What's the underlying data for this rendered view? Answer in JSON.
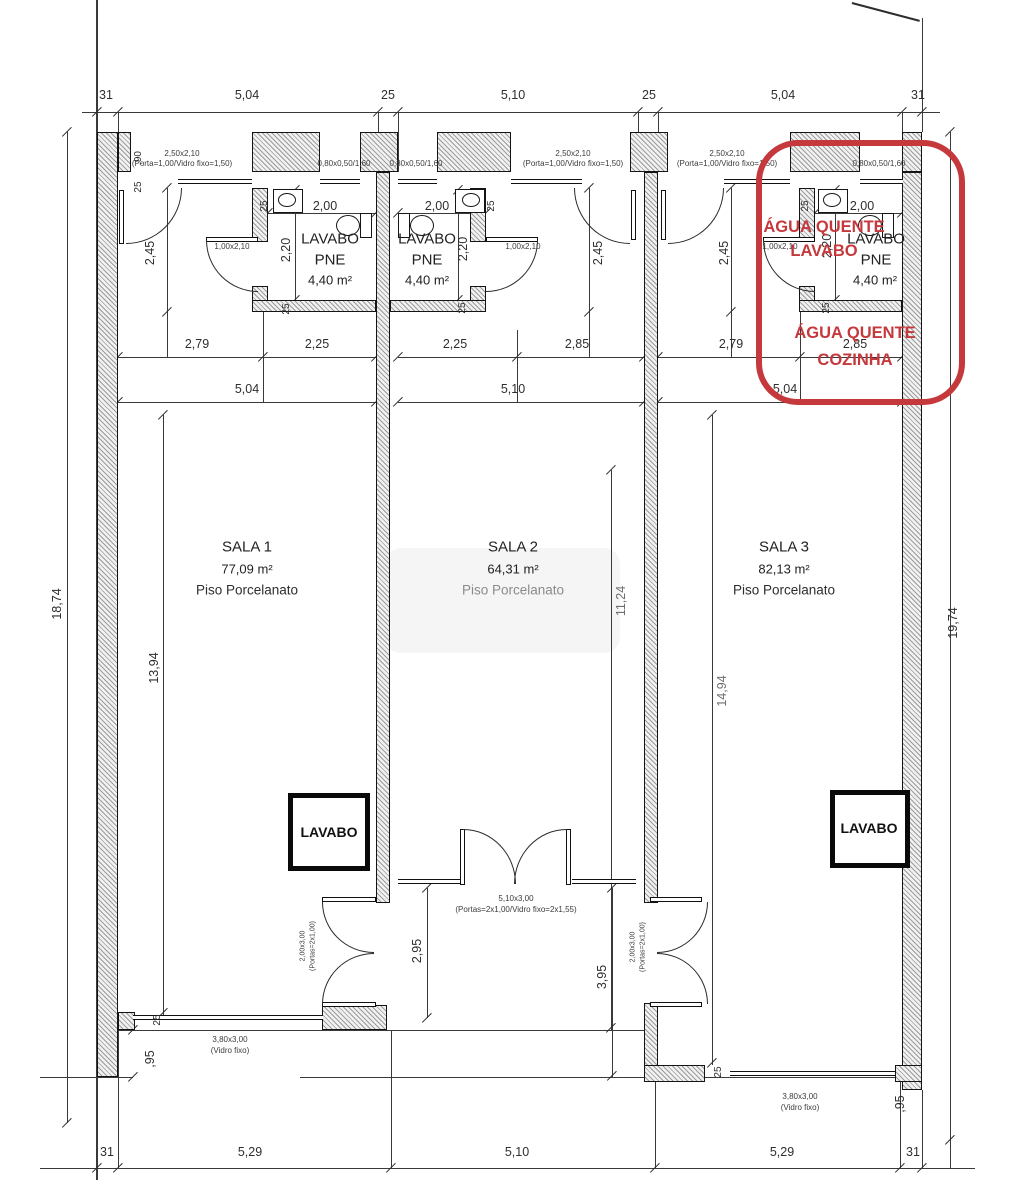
{
  "summary": {
    "type": "architectural floor plan - 3 commercial rooms",
    "highlight_color": "#c5393d",
    "units": [
      {
        "room": "SALA 1",
        "area": "77,09 m²",
        "floor": "Piso Porcelanato",
        "bath": "LAVABO PNE",
        "bath_area": "4,40 m²"
      },
      {
        "room": "SALA 2",
        "area": "64,31 m²",
        "floor": "Piso Porcelanato",
        "bath": "LAVABO PNE",
        "bath_area": "4,40 m²"
      },
      {
        "room": "SALA 3",
        "area": "82,13 m²",
        "floor": "Piso Porcelanato",
        "bath": "LAVABO PNE",
        "bath_area": "4,40 m²"
      }
    ],
    "red_notes": [
      "ÁGUA QUENTE LAVABO",
      "ÁGUA QUENTE COZINHA"
    ],
    "top_dimensions": [
      "31",
      "5,04",
      "25",
      "5,10",
      "25",
      "5,04",
      "31"
    ],
    "bottom_dimensions": [
      "31",
      "5,29",
      "5,10",
      "5,29",
      "31"
    ]
  },
  "labels": [
    {
      "name": "dim-top-31a",
      "text": "31",
      "x": 106,
      "y": 95
    },
    {
      "name": "dim-top-504a",
      "text": "5,04",
      "x": 247,
      "y": 95
    },
    {
      "name": "dim-top-25a",
      "text": "25",
      "x": 388,
      "y": 95
    },
    {
      "name": "dim-top-510",
      "text": "5,10",
      "x": 513,
      "y": 95
    },
    {
      "name": "dim-top-25b",
      "text": "25",
      "x": 649,
      "y": 95
    },
    {
      "name": "dim-top-504b",
      "text": "5,04",
      "x": 783,
      "y": 95
    },
    {
      "name": "dim-top-31b",
      "text": "31",
      "x": 918,
      "y": 95
    },
    {
      "name": "spec-door1-a",
      "text": "2,50x2,10",
      "x": 182,
      "y": 154,
      "size": 8,
      "color": "#3c3c3c"
    },
    {
      "name": "spec-door1-b",
      "text": "(Porta=1,00/Vidro fixo=1,50)",
      "x": 182,
      "y": 164,
      "size": 8,
      "color": "#3c3c3c"
    },
    {
      "name": "spec-win1",
      "text": "0,80x0,50/1,60",
      "x": 344,
      "y": 164,
      "size": 8,
      "color": "#3c3c3c"
    },
    {
      "name": "spec-win2",
      "text": "0,80x0,50/1,60",
      "x": 416,
      "y": 164,
      "size": 8,
      "color": "#3c3c3c"
    },
    {
      "name": "spec-door2-a",
      "text": "2,50x2,10",
      "x": 573,
      "y": 154,
      "size": 8,
      "color": "#3c3c3c"
    },
    {
      "name": "spec-door2-b",
      "text": "(Porta=1,00/Vidro fixo=1,50)",
      "x": 573,
      "y": 164,
      "size": 8,
      "color": "#3c3c3c"
    },
    {
      "name": "spec-door3-a",
      "text": "2,50x2,10",
      "x": 727,
      "y": 154,
      "size": 8,
      "color": "#3c3c3c"
    },
    {
      "name": "spec-door3-b",
      "text": "(Porta=1,00/Vidro fixo=1,50)",
      "x": 727,
      "y": 164,
      "size": 8,
      "color": "#3c3c3c"
    },
    {
      "name": "spec-win3",
      "text": "0,80x0,50/1,60",
      "x": 879,
      "y": 164,
      "size": 8,
      "color": "#3c3c3c"
    },
    {
      "name": "dim-90",
      "text": ",90",
      "x": 139,
      "y": 158,
      "rot": true,
      "size": 10
    },
    {
      "name": "dim-25-tl",
      "text": "25",
      "x": 139,
      "y": 187,
      "rot": true,
      "size": 10
    },
    {
      "name": "dim-200-u1",
      "text": "2,00",
      "x": 325,
      "y": 206
    },
    {
      "name": "dim-200-u2",
      "text": "2,00",
      "x": 437,
      "y": 206
    },
    {
      "name": "dim-200-u3",
      "text": "2,00",
      "x": 862,
      "y": 206
    },
    {
      "name": "dim-25-b1",
      "text": "25",
      "x": 265,
      "y": 206,
      "rot": true,
      "size": 10
    },
    {
      "name": "dim-25-b2",
      "text": "25",
      "x": 492,
      "y": 206,
      "rot": true,
      "size": 10
    },
    {
      "name": "dim-25-b3",
      "text": "25",
      "x": 806,
      "y": 206,
      "rot": true,
      "size": 10
    },
    {
      "name": "dim-220-u1",
      "text": "2,20",
      "x": 286,
      "y": 250,
      "rot": true
    },
    {
      "name": "dim-220-u2",
      "text": "2,20",
      "x": 463,
      "y": 249,
      "rot": true
    },
    {
      "name": "dim-220-u3",
      "text": "2,20",
      "x": 827,
      "y": 246,
      "rot": true
    },
    {
      "name": "dim-245-u1",
      "text": "2,45",
      "x": 150,
      "y": 253,
      "rot": true
    },
    {
      "name": "dim-245-u2",
      "text": "2,45",
      "x": 598,
      "y": 253,
      "rot": true
    },
    {
      "name": "dim-245-u3",
      "text": "2,45",
      "x": 724,
      "y": 253,
      "rot": true
    },
    {
      "name": "spec-bathdoor1",
      "text": "1,00x2,10",
      "x": 232,
      "y": 247,
      "size": 8,
      "color": "#3c3c3c"
    },
    {
      "name": "spec-bathdoor2",
      "text": "1,00x2,10",
      "x": 523,
      "y": 247,
      "size": 8,
      "color": "#3c3c3c"
    },
    {
      "name": "spec-bathdoor3",
      "text": "1,00x2,10",
      "x": 780,
      "y": 247,
      "size": 8,
      "color": "#3c3c3c"
    },
    {
      "name": "dim-25-c1",
      "text": "25",
      "x": 287,
      "y": 309,
      "rot": true,
      "size": 10
    },
    {
      "name": "dim-25-c2",
      "text": "25",
      "x": 463,
      "y": 308,
      "rot": true,
      "size": 10
    },
    {
      "name": "dim-25-c3",
      "text": "25",
      "x": 827,
      "y": 308,
      "rot": true,
      "size": 10
    },
    {
      "name": "room-bath1-name",
      "text": "LAVABO",
      "x": 330,
      "y": 239,
      "size": 15,
      "color": "#222222"
    },
    {
      "name": "room-bath1-pne",
      "text": "PNE",
      "x": 330,
      "y": 260,
      "size": 15,
      "color": "#222222"
    },
    {
      "name": "room-bath1-area",
      "text": "4,40 m²",
      "x": 330,
      "y": 280,
      "size": 13,
      "color": "#222222"
    },
    {
      "name": "room-bath2-name",
      "text": "LAVABO",
      "x": 427,
      "y": 239,
      "size": 15,
      "color": "#222222"
    },
    {
      "name": "room-bath2-pne",
      "text": "PNE",
      "x": 427,
      "y": 260,
      "size": 15,
      "color": "#222222"
    },
    {
      "name": "room-bath2-area",
      "text": "4,40 m²",
      "x": 427,
      "y": 280,
      "size": 13,
      "color": "#222222"
    },
    {
      "name": "room-bath3-name",
      "text": "LAVABO",
      "x": 876,
      "y": 239,
      "size": 15,
      "color": "#222222"
    },
    {
      "name": "room-bath3-pne",
      "text": "PNE",
      "x": 876,
      "y": 260,
      "size": 15,
      "color": "#222222"
    },
    {
      "name": "room-bath3-area",
      "text": "4,40 m²",
      "x": 875,
      "y": 280,
      "size": 13,
      "color": "#222222"
    },
    {
      "name": "dim-279-u1",
      "text": "2,79",
      "x": 197,
      "y": 344
    },
    {
      "name": "dim-225-u1",
      "text": "2,25",
      "x": 317,
      "y": 344
    },
    {
      "name": "dim-225-u2",
      "text": "2,25",
      "x": 455,
      "y": 344
    },
    {
      "name": "dim-285-u2",
      "text": "2,85",
      "x": 577,
      "y": 344
    },
    {
      "name": "dim-279-u3",
      "text": "2,79",
      "x": 731,
      "y": 344
    },
    {
      "name": "dim-285-u3",
      "text": "2,85",
      "x": 855,
      "y": 344
    },
    {
      "name": "dim-504-u1",
      "text": "5,04",
      "x": 247,
      "y": 389
    },
    {
      "name": "dim-510-u2",
      "text": "5,10",
      "x": 513,
      "y": 389
    },
    {
      "name": "dim-504-u3",
      "text": "5,04",
      "x": 785,
      "y": 389
    },
    {
      "name": "note-agua-quente-1",
      "text": "ÁGUA QUENTE",
      "x": 824,
      "y": 227,
      "size": 16.5,
      "bold": true,
      "color": "#c5393d"
    },
    {
      "name": "note-lavabo",
      "text": "LAVABO",
      "x": 824,
      "y": 251,
      "size": 16.5,
      "bold": true,
      "color": "#c5393d"
    },
    {
      "name": "note-agua-quente-2",
      "text": "ÁGUA QUENTE",
      "x": 855,
      "y": 333,
      "size": 16.5,
      "bold": true,
      "color": "#c5393d"
    },
    {
      "name": "note-cozinha",
      "text": "COZINHA",
      "x": 855,
      "y": 360,
      "size": 16.5,
      "bold": true,
      "color": "#c5393d"
    },
    {
      "name": "room-sala1-name",
      "text": "SALA 1",
      "x": 247,
      "y": 547,
      "size": 15,
      "color": "#222222"
    },
    {
      "name": "room-sala1-area",
      "text": "77,09 m²",
      "x": 247,
      "y": 569,
      "size": 13,
      "color": "#222222"
    },
    {
      "name": "room-sala1-floor",
      "text": "Piso Porcelanato",
      "x": 247,
      "y": 590,
      "size": 13.5,
      "color": "#2e2e2e"
    },
    {
      "name": "room-sala2-name",
      "text": "SALA 2",
      "x": 513,
      "y": 547,
      "size": 15,
      "color": "#222222"
    },
    {
      "name": "room-sala2-area",
      "text": "64,31 m²",
      "x": 513,
      "y": 569,
      "size": 13,
      "color": "#222222"
    },
    {
      "name": "room-sala2-floor",
      "text": "Piso Porcelanato",
      "x": 513,
      "y": 590,
      "size": 13.5,
      "color": "#8b8b8b"
    },
    {
      "name": "room-sala3-name",
      "text": "SALA 3",
      "x": 784,
      "y": 547,
      "size": 15,
      "color": "#222222"
    },
    {
      "name": "room-sala3-area",
      "text": "82,13 m²",
      "x": 784,
      "y": 569,
      "size": 13,
      "color": "#222222"
    },
    {
      "name": "room-sala3-floor",
      "text": "Piso Porcelanato",
      "x": 784,
      "y": 590,
      "size": 13.5,
      "color": "#2e2e2e"
    },
    {
      "name": "dim-1874",
      "text": "18,74",
      "x": 57,
      "y": 604,
      "rot": true
    },
    {
      "name": "dim-1394",
      "text": "13,94",
      "x": 154,
      "y": 668,
      "rot": true
    },
    {
      "name": "dim-1124",
      "text": "11,24",
      "x": 621,
      "y": 601,
      "rot": true,
      "color": "#6e6e6e"
    },
    {
      "name": "dim-1494",
      "text": "14,94",
      "x": 722,
      "y": 691,
      "rot": true,
      "color": "#6e6e6e"
    },
    {
      "name": "dim-1974",
      "text": "19,74",
      "x": 953,
      "y": 623,
      "rot": true
    },
    {
      "name": "lavbox1-label",
      "text": "LAVABO",
      "x": 329,
      "y": 832,
      "size": 14,
      "bold": true,
      "color": "#111111"
    },
    {
      "name": "lavbox2-label",
      "text": "LAVABO",
      "x": 869,
      "y": 828,
      "size": 14,
      "bold": true,
      "color": "#111111"
    },
    {
      "name": "spec-reardoor1-a",
      "text": "2,00x3,00",
      "x": 303,
      "y": 946,
      "rot": true,
      "size": 7,
      "color": "#3c3c3c"
    },
    {
      "name": "spec-reardoor1-b",
      "text": "(Portas=2x1,00)",
      "x": 313,
      "y": 946,
      "rot": true,
      "size": 7,
      "color": "#3c3c3c"
    },
    {
      "name": "spec-reardoor3-a",
      "text": "2,00x3,00",
      "x": 633,
      "y": 947,
      "rot": true,
      "size": 7,
      "color": "#3c3c3c"
    },
    {
      "name": "spec-reardoor3-b",
      "text": "(Portas=2x1,00)",
      "x": 643,
      "y": 947,
      "rot": true,
      "size": 7,
      "color": "#3c3c3c"
    },
    {
      "name": "dim-295",
      "text": "2,95",
      "x": 417,
      "y": 951,
      "rot": true
    },
    {
      "name": "dim-395",
      "text": "3,95",
      "x": 602,
      "y": 977,
      "rot": true
    },
    {
      "name": "spec-centerdoor-a",
      "text": "5,10x3,00",
      "x": 516,
      "y": 899,
      "size": 8,
      "color": "#3c3c3c"
    },
    {
      "name": "spec-centerdoor-b",
      "text": "(Portas=2x1,00/Vidro fixo=2x1,55)",
      "x": 516,
      "y": 910,
      "size": 8,
      "color": "#3c3c3c"
    },
    {
      "name": "spec-frontwin1-a",
      "text": "3,80x3,00",
      "x": 230,
      "y": 1040,
      "size": 8,
      "color": "#3c3c3c"
    },
    {
      "name": "spec-frontwin1-b",
      "text": "(Vidro fixo)",
      "x": 230,
      "y": 1051,
      "size": 8,
      "color": "#3c3c3c"
    },
    {
      "name": "spec-frontwin3-a",
      "text": "3,80x3,00",
      "x": 800,
      "y": 1097,
      "size": 8,
      "color": "#3c3c3c"
    },
    {
      "name": "spec-frontwin3-b",
      "text": "(Vidro fixo)",
      "x": 800,
      "y": 1108,
      "size": 8,
      "color": "#3c3c3c"
    },
    {
      "name": "dim-25-fl",
      "text": "25",
      "x": 158,
      "y": 1020,
      "rot": true,
      "size": 10
    },
    {
      "name": "dim-95-left",
      "text": ",95",
      "x": 150,
      "y": 1059,
      "rot": true
    },
    {
      "name": "dim-25-fr",
      "text": "25",
      "x": 719,
      "y": 1072,
      "rot": true,
      "size": 10
    },
    {
      "name": "dim-95-right",
      "text": ",95",
      "x": 900,
      "y": 1104,
      "rot": true
    },
    {
      "name": "dim-bot-31a",
      "text": "31",
      "x": 107,
      "y": 1152
    },
    {
      "name": "dim-bot-529a",
      "text": "5,29",
      "x": 250,
      "y": 1152
    },
    {
      "name": "dim-bot-510",
      "text": "5,10",
      "x": 517,
      "y": 1152
    },
    {
      "name": "dim-bot-529b",
      "text": "5,29",
      "x": 782,
      "y": 1152
    },
    {
      "name": "dim-bot-31b",
      "text": "31",
      "x": 913,
      "y": 1152
    }
  ]
}
